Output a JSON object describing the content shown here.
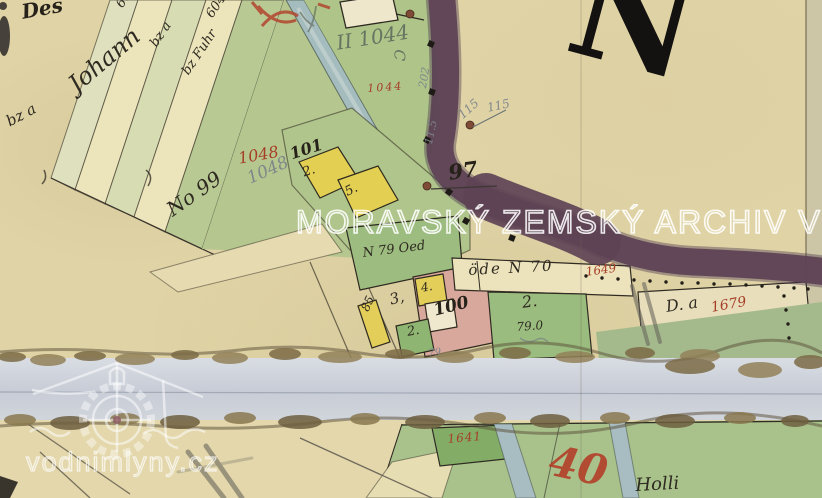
{
  "palette": {
    "parchment": "#e2d6a9",
    "sheet_gap_band": "#ccd1d9",
    "field_green": "#aec489",
    "strip_green": "#d8dcb2",
    "stream_blue": "#a4bcbe",
    "road_purple": "#5e4355",
    "parcel_yellow": "#e3cf52",
    "parcel_pink": "#d9a89c",
    "parcel_green_dark": "#8fb573",
    "cream_parcel": "#ece2bc",
    "ink": "#2f2a21",
    "red_ink": "#a63e28",
    "pencil": "#7c848a",
    "watermark": "#ffffff"
  },
  "watermarks": {
    "archive": "MORAVSKÝ ZEMSKÝ ARCHIV V BRN",
    "site": "vodnimlyny.cz"
  },
  "sheet": {
    "corner_letter": "N"
  },
  "annotations": {
    "des": "Des",
    "johann": "Johann",
    "bz_a": "bz a",
    "no_99": "No 99",
    "strip_6049": "6049",
    "strip_6049_b": "6049",
    "strip_bz_a": "bz a",
    "strip_bz_fuhr": "bz Fuhr",
    "red_1048": "1048",
    "pencil_1048": "1048",
    "n_101": "101",
    "q_101": "2.",
    "q_5": "5.",
    "pencil_ii_1044": "II 1044",
    "pencil_c": "C",
    "red_1044": "1044",
    "pencil_202": "202",
    "pencil_115_a": "115",
    "pencil_115_b": "115",
    "pencil_11_5": "11.5",
    "n_97": "97",
    "ode_n_70": "öde N 70",
    "red_1649": "1649",
    "n_79_oed": "N 79 Oed",
    "q_3": "3,",
    "q_4": "4.",
    "n_100": "100",
    "n_85": "85",
    "q_2_small": "2.",
    "pencil_79": "79",
    "q_2_c": "2.",
    "n_79_0": "79.0",
    "d_a": "D. a",
    "red_1679": "1679",
    "red_1641": "1641",
    "red_40": "40",
    "holli": "Holli"
  }
}
